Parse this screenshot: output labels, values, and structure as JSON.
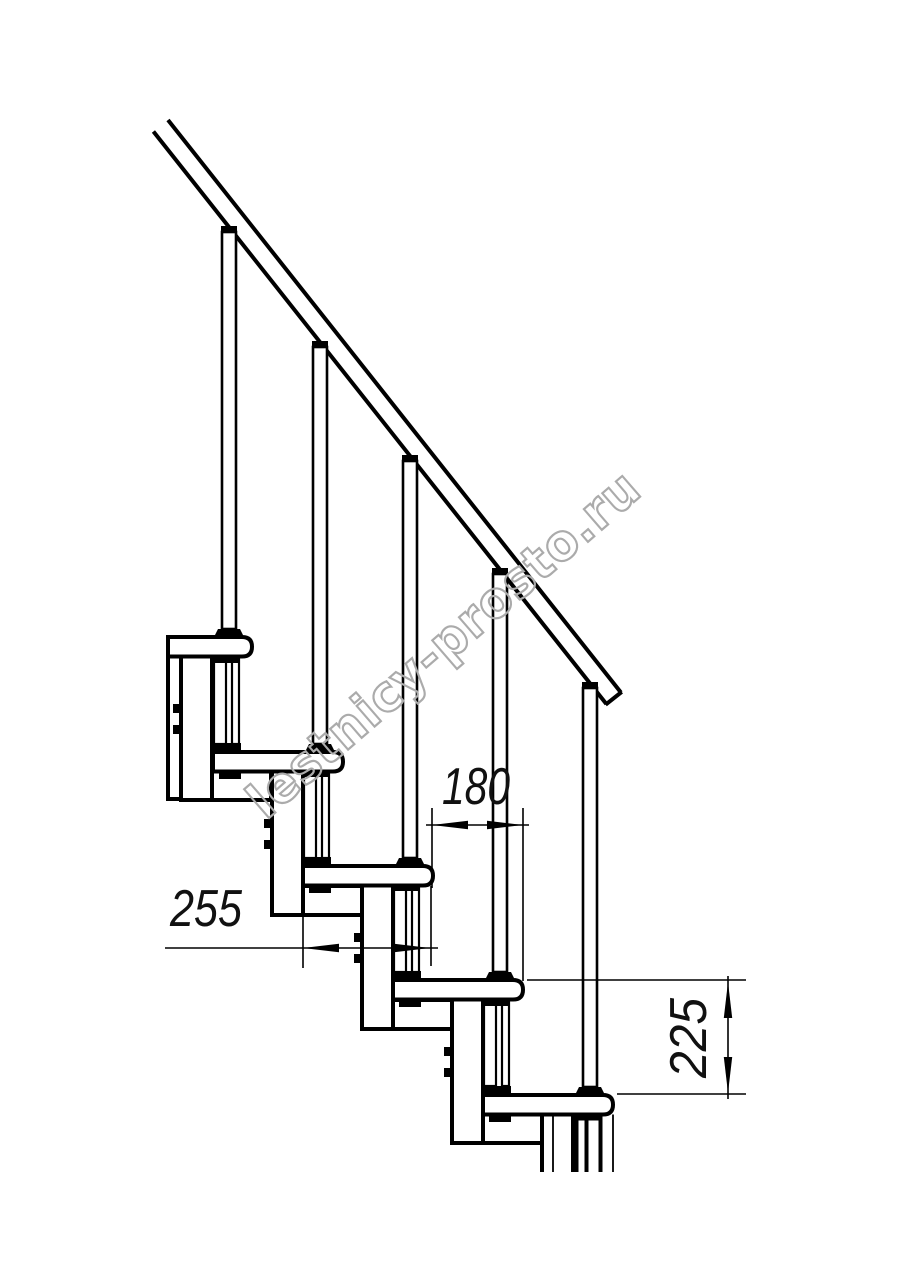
{
  "watermark": "lestnicy-prosto.ru",
  "dimensions": {
    "step_run": "180",
    "tread_depth": "255",
    "step_rise": "225"
  }
}
